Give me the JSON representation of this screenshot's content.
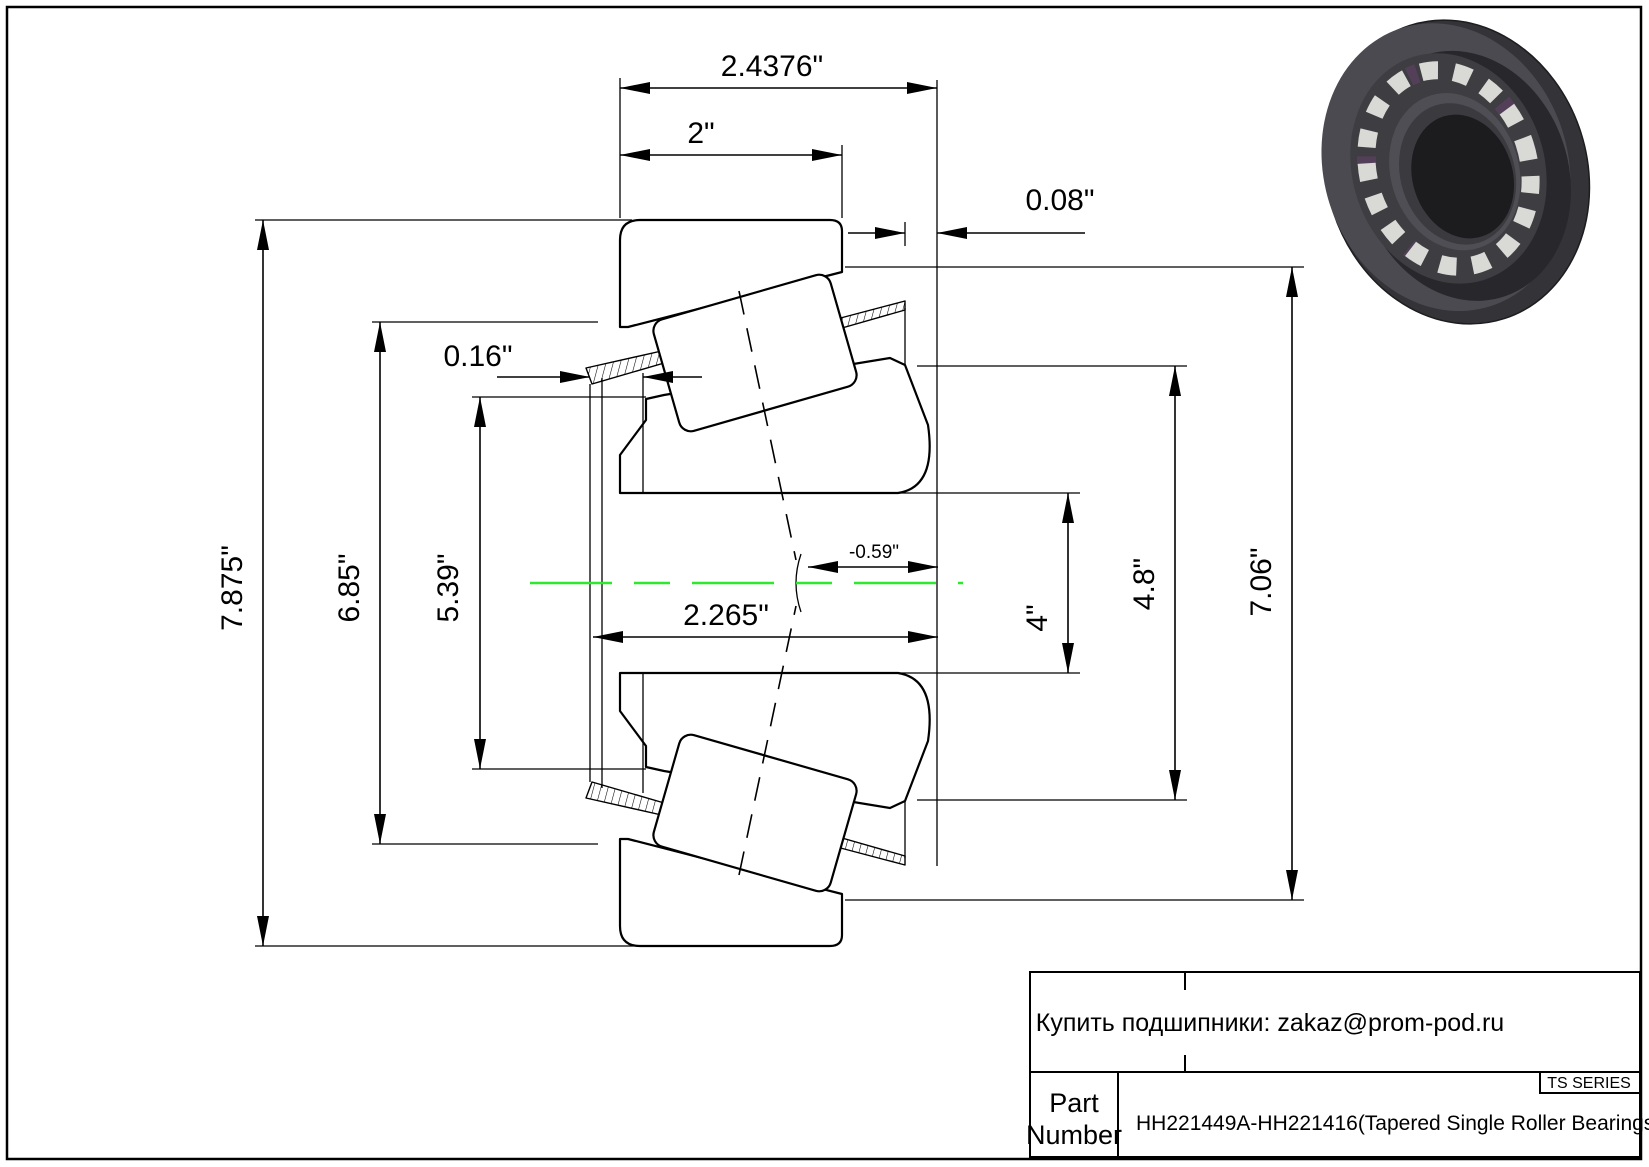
{
  "diagram": {
    "dims": {
      "overall_width": "2.4376\"",
      "cup_width": "2\"",
      "cage_protrusion": "0.08\"",
      "lip_protrusion": "0.16\"",
      "effective_center": "-0.59\"",
      "cone_width": "2.265\"",
      "outer_diameter": "7.875\"",
      "cage_front_diameter": "6.85\"",
      "rib_diameter": "5.39\"",
      "bore_diameter": "4\"",
      "cone_back_rib": "4.8\"",
      "cage_back_diameter": "7.06\""
    },
    "centerline_color": "#2ee82e"
  },
  "title_block": {
    "contact": "Купить подшипники: zakaz@prom-pod.ru",
    "series_label": "TS SERIES",
    "part_label_line1": "Part",
    "part_label_line2": "Number",
    "part_number": "HH221449A-HH221416(Tapered Single Roller Bearings)"
  }
}
